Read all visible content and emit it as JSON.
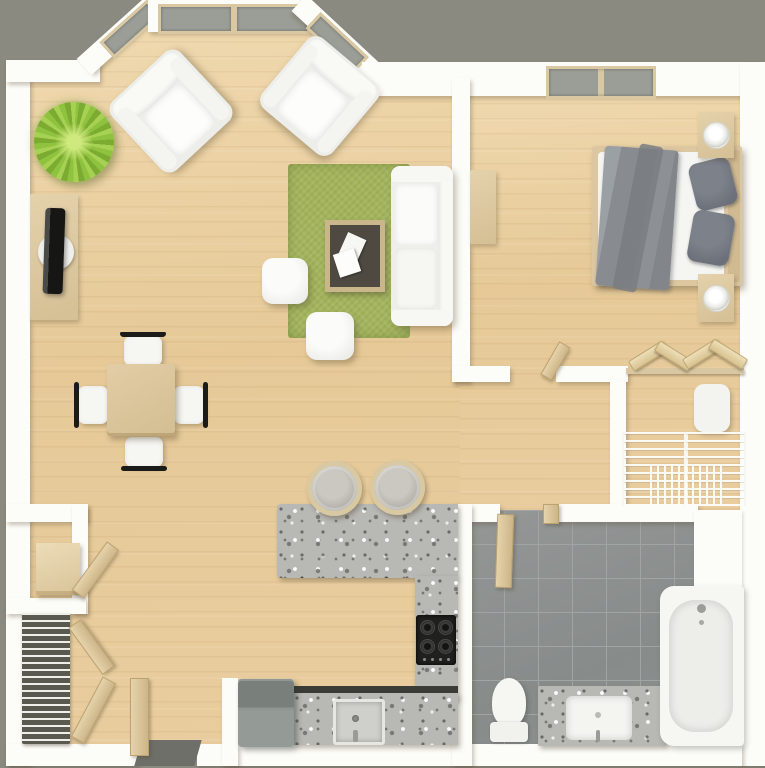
{
  "scene": {
    "title": "3D floor plan of a one-bedroom apartment, top-down view",
    "background_color": "#8a8a80",
    "wall_color": "#fcfcf8",
    "floor_color": "#e7cb9e"
  },
  "palette": {
    "wood_floor": "#e7cb9e",
    "wall_white": "#fcfcf8",
    "bath_tile_gray": "#8d908f",
    "granite_counter": "#b8b8b4",
    "rug_green": "#a3b45c",
    "plant_green": "#8fc23f",
    "bedding_gray": "#888c91",
    "furniture_beige": "#dcc69e",
    "appliance_gray": "#8e9490",
    "frame_black": "#1b1b19"
  },
  "rooms": {
    "living": {
      "label": "Living room",
      "items": [
        "bay window with angled panes",
        "two windows on top wall",
        "two white armchairs",
        "potted plant",
        "TV on media stand",
        "green area rug",
        "white sofa",
        "coffee table with magazines",
        "two white ottomans"
      ]
    },
    "dining": {
      "label": "Dining area",
      "items": [
        "square wooden table",
        "four chairs with black frames"
      ]
    },
    "bedroom": {
      "label": "Bedroom",
      "items": [
        "double bed with gray blanket",
        "two gray pillows",
        "two nightstands with lamps",
        "dresser",
        "window"
      ]
    },
    "closet": {
      "label": "Closet",
      "items": [
        "hanging rod with wooden hangers",
        "laundry hamper",
        "wire basket drawers"
      ]
    },
    "bathroom": {
      "label": "Bathroom",
      "items": [
        "open wooden door",
        "toilet",
        "granite vanity with sink",
        "bathtub",
        "gray tile floor"
      ]
    },
    "kitchen": {
      "label": "Kitchen",
      "items": [
        "granite breakfast bar",
        "two bar stools",
        "U-shaped granite counter",
        "black cooktop",
        "kitchen sink",
        "gray appliance"
      ]
    },
    "entry": {
      "label": "Entry",
      "items": [
        "open front door",
        "dark doormat",
        "storage closet with shelf box",
        "slatted shoe rack",
        "open folding doors"
      ]
    }
  },
  "labels": {
    "plant": "Potted plant",
    "tv": "TV on media stand",
    "armchair": "Armchair",
    "rug": "Green rug",
    "sofa": "Sofa",
    "coffee_table": "Coffee table",
    "ottoman": "Ottoman",
    "dining_table": "Dining table",
    "dining_chair": "Dining chair",
    "bed": "Double bed",
    "nightstand": "Nightstand with lamp",
    "dresser": "Dresser",
    "hamper": "Laundry hamper",
    "hangers": "Hangers on rod",
    "baskets": "Wire baskets",
    "toilet": "Toilet",
    "vanity": "Granite vanity with sink",
    "bathtub": "Bathtub",
    "bath_door": "Bathroom door",
    "bar": "Breakfast bar",
    "stool": "Bar stool",
    "cooktop": "Cooktop",
    "kitchen_sink": "Kitchen sink",
    "washer": "Appliance",
    "front_door": "Front door",
    "doormat": "Doormat",
    "shoe_rack": "Shoe rack",
    "shelf_box": "Storage box",
    "closet_door": "Closet door panel",
    "window": "Window"
  }
}
